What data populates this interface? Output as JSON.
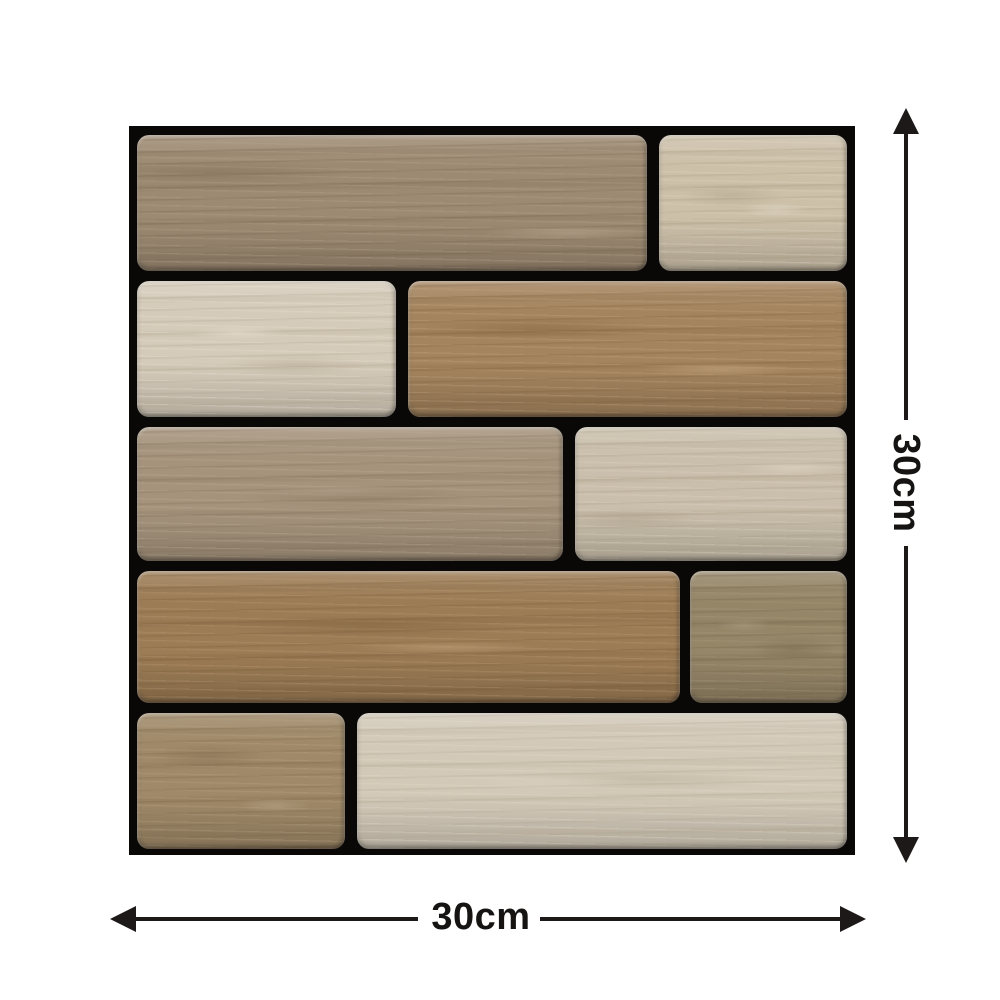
{
  "image": {
    "type": "product-dimension-diagram",
    "subject": "peel-and-stick wood-look mosaic wall tile",
    "background_color": "#ffffff"
  },
  "dimensions": {
    "vertical_label": "30cm",
    "horizontal_label": "30cm",
    "arrow_color": "#1d1918",
    "label_color": "#161412"
  },
  "tile": {
    "frame_color": "#0a0807",
    "grout_color": "#0a0807",
    "rows": 5,
    "planks": [
      {
        "name": "row1-left",
        "tone": "taupe-brown",
        "rect": [
          8,
          9,
          510,
          136
        ],
        "base": "#9d8a72",
        "dark": "#6f5d47",
        "light": "#b7a68e"
      },
      {
        "name": "row1-right",
        "tone": "light-greige",
        "rect": [
          530,
          9,
          188,
          136
        ],
        "base": "#ccc0a9",
        "dark": "#a2947a",
        "light": "#e0d7c4"
      },
      {
        "name": "row2-left",
        "tone": "pale-cream",
        "rect": [
          8,
          155,
          259,
          136
        ],
        "base": "#d5cbba",
        "dark": "#a99c85",
        "light": "#e9e1d3"
      },
      {
        "name": "row2-right",
        "tone": "warm-brown",
        "rect": [
          279,
          155,
          439,
          136
        ],
        "base": "#a4845e",
        "dark": "#785937",
        "light": "#c2a580"
      },
      {
        "name": "row3-left",
        "tone": "gray-taupe",
        "rect": [
          8,
          301,
          426,
          134
        ],
        "base": "#a5937c",
        "dark": "#7a6851",
        "light": "#bfae97"
      },
      {
        "name": "row3-right",
        "tone": "light-greige",
        "rect": [
          446,
          301,
          272,
          134
        ],
        "base": "#cabfac",
        "dark": "#a0937b",
        "light": "#ded5c3"
      },
      {
        "name": "row4-left",
        "tone": "rich-brown",
        "rect": [
          8,
          445,
          543,
          132
        ],
        "base": "#9c7c55",
        "dark": "#6f5432",
        "light": "#bb9c75"
      },
      {
        "name": "row4-right",
        "tone": "dark-taupe",
        "rect": [
          561,
          445,
          157,
          132
        ],
        "base": "#968668",
        "dark": "#6a5a41",
        "light": "#ac9c7f"
      },
      {
        "name": "row5-left",
        "tone": "taupe-brown",
        "rect": [
          8,
          587,
          208,
          136
        ],
        "base": "#9f8968",
        "dark": "#755f43",
        "light": "#b9a586"
      },
      {
        "name": "row5-right",
        "tone": "light-greige",
        "rect": [
          228,
          587,
          490,
          136
        ],
        "base": "#d2c9b8",
        "dark": "#ab9f89",
        "light": "#e3dbcc"
      }
    ]
  }
}
